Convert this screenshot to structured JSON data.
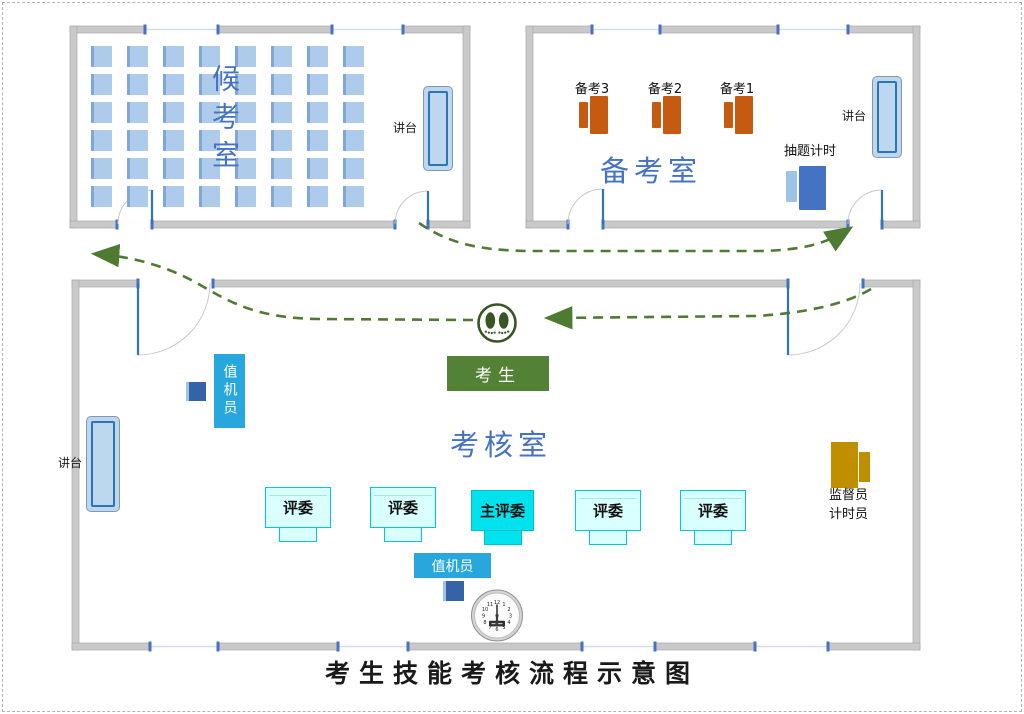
{
  "title": "考生技能考核流程示意图",
  "colors": {
    "room_label_blue": "#4472C4",
    "wall_gray": "#C9C9C9",
    "door_blue": "#2E75B6",
    "seat_blue": "#AECBEB",
    "desk_orange": "#C55A11",
    "timer_desk_blue": "#4472C4",
    "operator_cyan": "#28A7DF",
    "judge_cyan_light": "#D9FFFF",
    "chief_judge_cyan": "#00E3EE",
    "candidate_green": "#538135",
    "supervisor_gold": "#BF8F00",
    "arrow_green": "#4E7A32"
  },
  "waiting_room": {
    "name": "候考室",
    "podium_label": "讲台",
    "seats": {
      "rows": 6,
      "cols": 8
    }
  },
  "prep_room": {
    "name": "备考室",
    "podium_label": "讲台",
    "desks": [
      {
        "label": "备考3"
      },
      {
        "label": "备考2"
      },
      {
        "label": "备考1"
      }
    ],
    "timer_station_label": "抽题计时"
  },
  "exam_room": {
    "name": "考核室",
    "podium_label": "讲台",
    "operator_top_label": "值机员",
    "operator_bottom_label": "值机员",
    "judges": [
      {
        "label": "评委"
      },
      {
        "label": "评委"
      },
      {
        "label": "主评委"
      },
      {
        "label": "评委"
      },
      {
        "label": "评委"
      }
    ],
    "supervisor_labels": [
      "监督员",
      "计时员"
    ],
    "candidate_label": "考生",
    "clock": {
      "numbers": [
        "12",
        "1",
        "2",
        "3",
        "4",
        "5",
        "6",
        "7",
        "8",
        "9",
        "10",
        "11"
      ],
      "time": "6:00"
    }
  }
}
